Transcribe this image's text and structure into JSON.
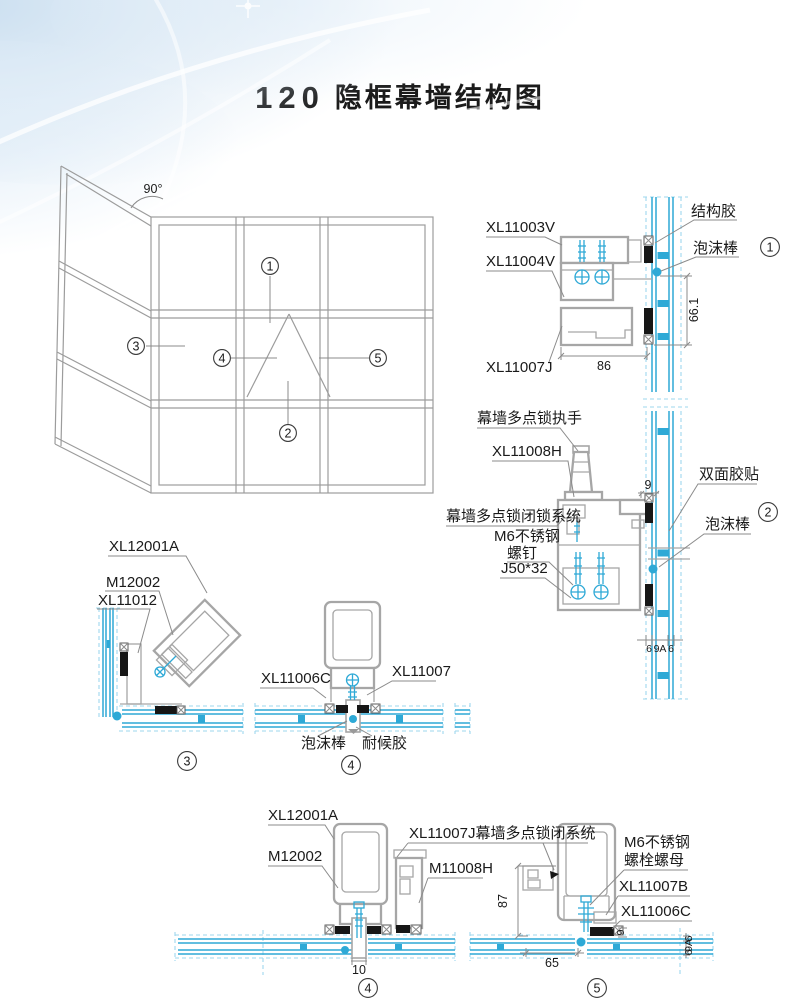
{
  "title": {
    "number": "120",
    "text": "隐框幕墙结构图"
  },
  "colors": {
    "glass": "#2ea9d6",
    "glass_dashed": "#9ed7ee",
    "profile": "#a6a6a6",
    "gasket": "#161616",
    "text": "#1a1a1a",
    "leader": "#8b8b8b"
  },
  "elevation": {
    "angle": "90°",
    "callout1": "1",
    "callout2": "2",
    "callout3": "3",
    "callout4": "4",
    "callout5": "5"
  },
  "detail1": {
    "num": "1",
    "xl11003v": "XL11003V",
    "xl11004v": "XL11004V",
    "xl11007j": "XL11007J",
    "sealant": "结构胶",
    "foam": "泡沫棒",
    "dim_h": "66.1",
    "dim_w": "86"
  },
  "detail2": {
    "num": "2",
    "handle": "幕墙多点锁执手",
    "xl11008h": "XL11008H",
    "lock_system": "幕墙多点锁闭锁系统",
    "m6_1": "M6不锈钢",
    "m6_2": "螺钉",
    "j50": "J50*32",
    "tape": "双面胶贴",
    "foam": "泡沫棒",
    "dim_cap": "9",
    "g1": "6",
    "g2": "9A",
    "g3": "6"
  },
  "detail3": {
    "num": "3",
    "xl12001a": "XL12001A",
    "m12002": "M12002",
    "xl11012": "XL11012"
  },
  "detail4": {
    "num": "4",
    "xl11006c": "XL11006C",
    "xl11007": "XL11007",
    "foam": "泡沫棒",
    "sealant": "耐候胶"
  },
  "detail5": {
    "num": "5",
    "num_left": "4",
    "xl12001a": "XL12001A",
    "m12002": "M12002",
    "lock_label": "XL11007J幕墙多点锁闭系统",
    "m11008h": "M11008H",
    "m6_1": "M6不锈钢",
    "m6_2": "螺栓螺母",
    "xl11007b": "XL11007B",
    "xl11006c": "XL11006C",
    "dim_h": "87",
    "dim_tongue": "10",
    "dim_w": "65",
    "dim_gasket": "9",
    "g1": "6",
    "g2": "9A",
    "g3": "6"
  }
}
